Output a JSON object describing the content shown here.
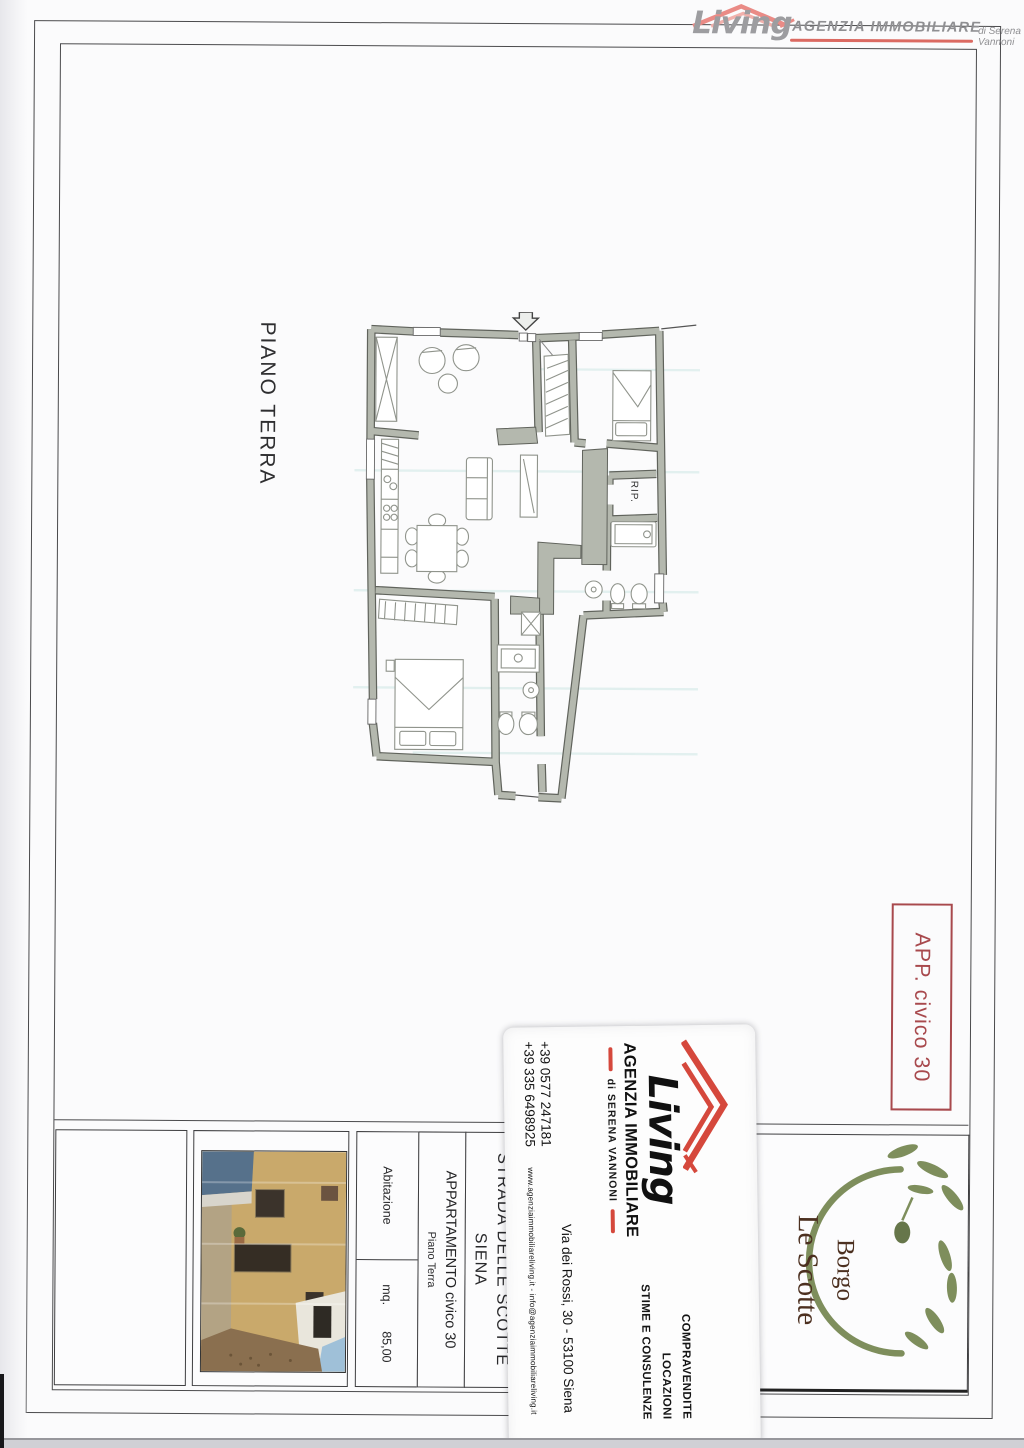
{
  "header": {
    "brand": "Living",
    "brand_sub": "AGENZIA IMMOBILIARE",
    "brand_by": "di Serena Vannoni"
  },
  "plan": {
    "floor_label": "PIANO TERRA",
    "closet_label": "RIP.",
    "unit_badge": "APP. civico 30"
  },
  "title_block": {
    "category_label": "Abitazione",
    "area_label": "mq.",
    "area_value": "85,00",
    "unit_line1": "APPARTAMENTO civico 30",
    "unit_line2": "Piano Terra",
    "address_line1": "STRADA DELLE SCOTTE",
    "address_line2": "SIENA",
    "residence_line1": "Borgo",
    "residence_line2": "Le Scotte"
  },
  "business_card": {
    "brand": "Living",
    "brand_sub": "AGENZIA IMMOBILIARE",
    "brand_by": "di SERENA VANNONI",
    "phone1": "+39 0577 247181",
    "phone2": "+39 335 6498925",
    "web_email": "www.agenziaimmobiliareliving.it - info@agenziaimmobiliareliving.it",
    "address": "Via dei Rossi, 30 - 53100 Siena",
    "services": [
      "COMPRAVENDITE",
      "LOCAZIONI",
      "STIME E CONSULENZE"
    ]
  },
  "colors": {
    "badge_red": "#a8494d",
    "logo_pink": "#ea8b86",
    "card_red": "#d5483c",
    "wall_gray": "#b4b8ae",
    "olive_green": "#7e8e5c",
    "residence_brown": "#4c3020"
  }
}
